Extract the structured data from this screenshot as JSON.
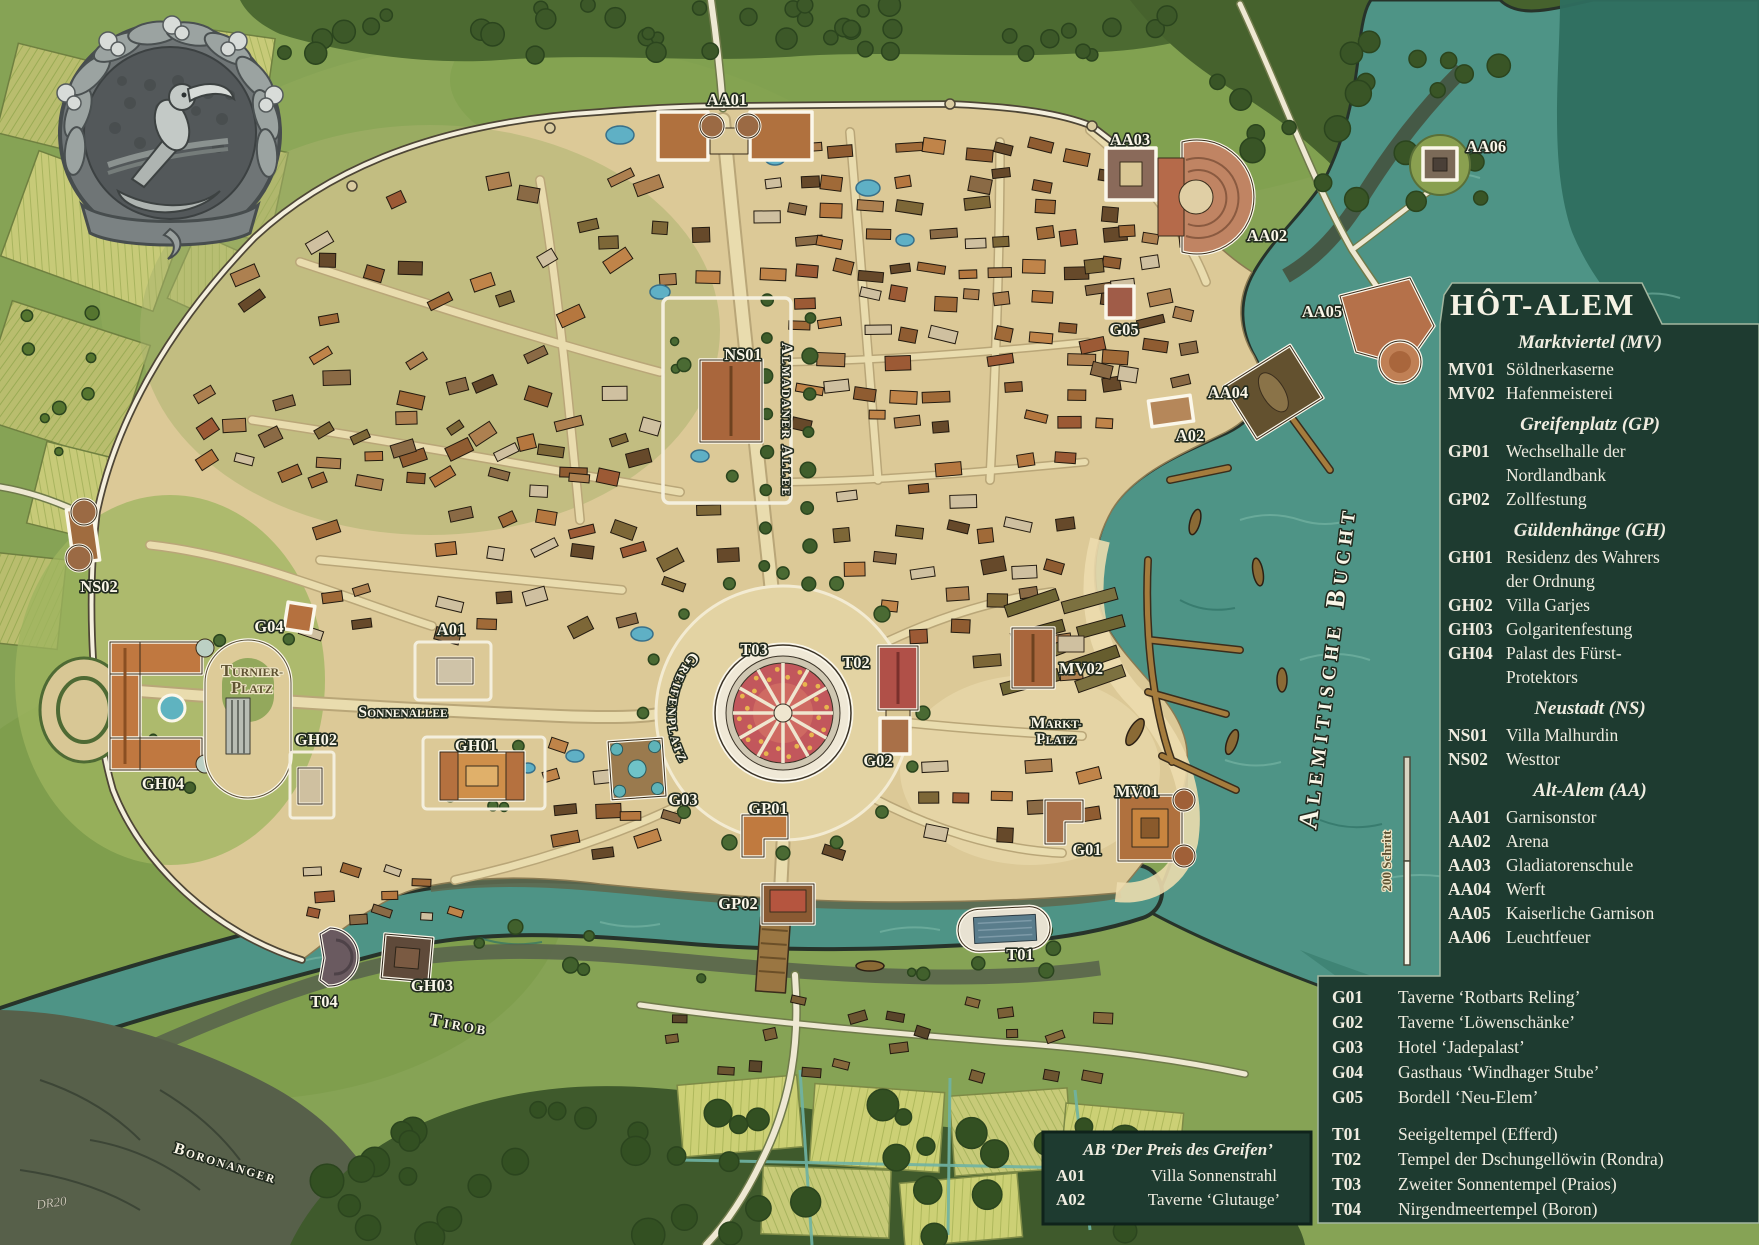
{
  "title": "HÔT-ALEM",
  "legend": {
    "sections": [
      {
        "header": "Marktviertel (MV)",
        "items": [
          {
            "code": "MV01",
            "name": "Söldnerkaserne"
          },
          {
            "code": "MV02",
            "name": "Hafenmeisterei"
          }
        ]
      },
      {
        "header": "Greifenplatz (GP)",
        "items": [
          {
            "code": "GP01",
            "name": "Wechselhalle der\nNordlandbank"
          },
          {
            "code": "GP02",
            "name": "Zollfestung"
          }
        ]
      },
      {
        "header": "Güldenhänge (GH)",
        "items": [
          {
            "code": "GH01",
            "name": "Residenz des Wahrers\nder Ordnung"
          },
          {
            "code": "GH02",
            "name": "Villa Garjes"
          },
          {
            "code": "GH03",
            "name": "Golgaritenfestung"
          },
          {
            "code": "GH04",
            "name": "Palast des Fürst-\nProtektors"
          }
        ]
      },
      {
        "header": "Neustadt (NS)",
        "items": [
          {
            "code": "NS01",
            "name": "Villa Malhurdin"
          },
          {
            "code": "NS02",
            "name": "Westtor"
          }
        ]
      },
      {
        "header": "Alt-Alem (AA)",
        "items": [
          {
            "code": "AA01",
            "name": "Garnisonstor"
          },
          {
            "code": "AA02",
            "name": "Arena"
          },
          {
            "code": "AA03",
            "name": "Gladiatorenschule"
          },
          {
            "code": "AA04",
            "name": "Werft"
          },
          {
            "code": "AA05",
            "name": "Kaiserliche Garnison"
          },
          {
            "code": "AA06",
            "name": "Leuchtfeuer"
          }
        ]
      }
    ]
  },
  "poi_legend": {
    "groups": [
      [
        {
          "code": "G01",
          "name": "Taverne ‘Rotbarts Reling’"
        },
        {
          "code": "G02",
          "name": "Taverne ‘Löwenschänke’"
        },
        {
          "code": "G03",
          "name": "Hotel ‘Jadepalast’"
        },
        {
          "code": "G04",
          "name": "Gasthaus ‘Windhager Stube’"
        },
        {
          "code": "G05",
          "name": "Bordell ‘Neu-Elem’"
        }
      ],
      [
        {
          "code": "T01",
          "name": "Seeigeltempel (Efferd)"
        },
        {
          "code": "T02",
          "name": "Tempel der Dschungellöwin (Rondra)"
        },
        {
          "code": "T03",
          "name": "Zweiter Sonnentempel (Praios)"
        },
        {
          "code": "T04",
          "name": "Nirgendmeertempel (Boron)"
        }
      ]
    ]
  },
  "ab_box": {
    "title": "AB ‘Der Preis des Greifen’",
    "items": [
      {
        "code": "A01",
        "name": "Villa Sonnenstrahl"
      },
      {
        "code": "A02",
        "name": "Taverne ‘Glutauge’"
      }
    ]
  },
  "map_labels": {
    "AA01": "AA01",
    "AA02": "AA02",
    "AA03": "AA03",
    "AA04": "AA04",
    "AA05": "AA05",
    "AA06": "AA06",
    "NS01": "NS01",
    "NS02": "NS02",
    "G01": "G01",
    "G02": "G02",
    "G03": "G03",
    "G04": "G04",
    "G05": "G05",
    "T01": "T01",
    "T02": "T02",
    "T03": "T03",
    "T04": "T04",
    "GH01": "GH01",
    "GH02": "GH02",
    "GH03": "GH03",
    "GH04": "GH04",
    "GP01": "GP01",
    "GP02": "GP02",
    "MV01": "MV01",
    "MV02": "MV02",
    "A01": "A01",
    "A02": "A02",
    "turnierplatz": [
      "Turnier-",
      "platz"
    ],
    "marktplatz": [
      "Markt-",
      "platz"
    ],
    "sonnenallee": "Sonnenallee",
    "almadaner_allee": "Almadaner Allee",
    "greifenplatz": "Greifenplatz",
    "tirob": "Tirob",
    "boronanger": "Boronanger",
    "bucht": "Alemitische Bucht",
    "scale_label": "200 Schritt",
    "signature": "DR20"
  },
  "colors": {
    "panel": "#1e3b30",
    "panel_border": "#a3b7a0",
    "panel_text": "#efece0",
    "water": "#4e9486",
    "deep_water": "#2e6e5f",
    "grass": "#86a355",
    "sand": "#dcc997",
    "label": "#faf6e8",
    "label_stroke": "#222b1f",
    "temple_wheel": "#c2575c"
  }
}
